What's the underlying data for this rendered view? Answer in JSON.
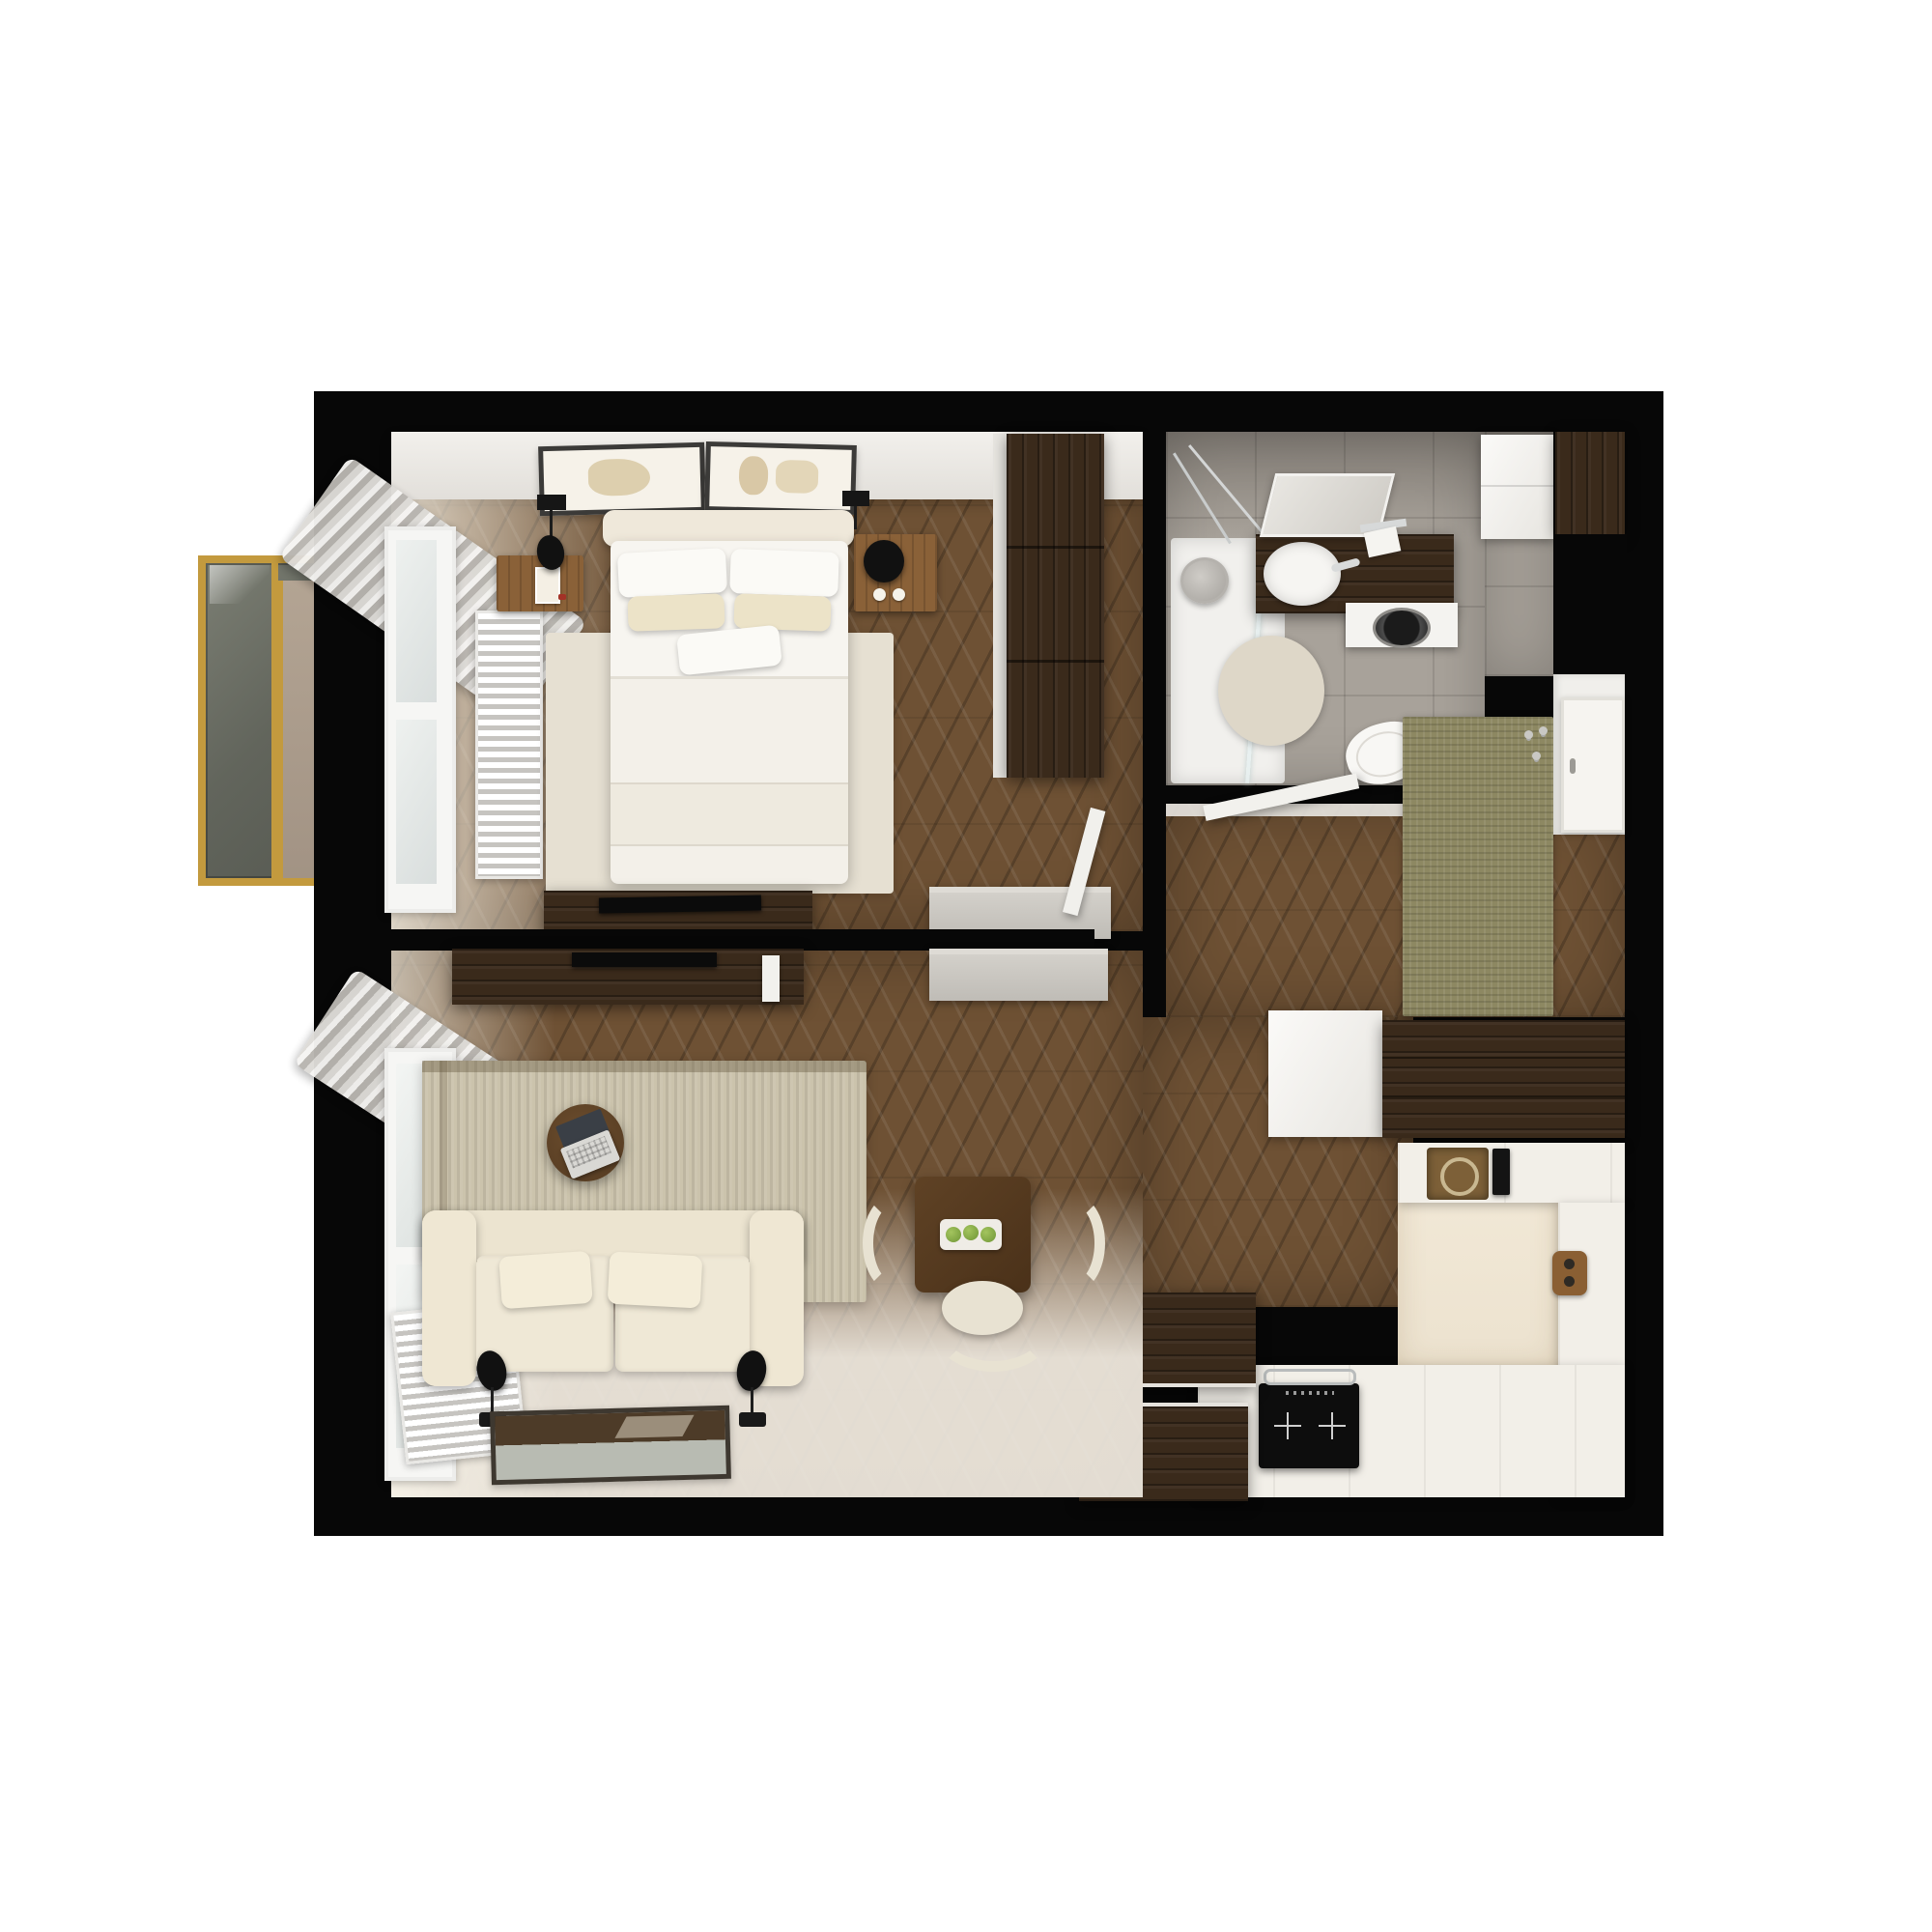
{
  "scene": {
    "type": "3d-floor-plan-top-down-render",
    "subject": "one-bedroom apartment interior visualization",
    "background": "#ffffff",
    "no_visible_text": true
  },
  "colors": {
    "paper": "#ffffff",
    "wall": "#070707",
    "wood": "#6e5134",
    "darkwood": "#3a2a1b",
    "midwood": "#8a6138",
    "tile": "#a8a29a",
    "counter": "#f2efe8",
    "cream": "#efe8d6",
    "rug-beige": "#e6e0d2",
    "rug-living": "#cbc3ac",
    "rug-green": "#8d8862",
    "gold": "#c39a3e",
    "apple-green": "#7ca23c",
    "appliance-black": "#0d0d0d"
  },
  "rooms": [
    {
      "id": "bedroom",
      "position": "top-left",
      "furniture": [
        "double-bed",
        "headboard",
        "pillows",
        "duvet",
        "nightstand-left-with-art-card",
        "nightstand-right-with-lamp",
        "wall-sconce-left",
        "wall-sconce-right",
        "two-framed-artworks",
        "radiator",
        "window",
        "curtains",
        "beige-area-rug",
        "dark-wardrobe",
        "media-bench-with-tv",
        "grey-sideboard",
        "open-door"
      ]
    },
    {
      "id": "bathroom",
      "position": "top-right",
      "furniture": [
        "walk-in-shower",
        "rain-shower-head",
        "glass-partition",
        "dark-wood-vanity",
        "white-basin",
        "tilted-mirror",
        "toilet-paper-holder",
        "washing-machine",
        "round-beige-rug",
        "wall-hung-toilet",
        "flush-plate",
        "white-storage-cabinet",
        "dark-storage-cabinet"
      ]
    },
    {
      "id": "hallway-entry",
      "position": "middle-right",
      "furniture": [
        "open-bathroom-door",
        "green-runner-rug",
        "entry-vestibule",
        "front-door",
        "coat-hooks",
        "gloss-white-cabinet",
        "dark-wardrobe-cabinet"
      ]
    },
    {
      "id": "kitchen",
      "position": "bottom-right",
      "furniture": [
        "u-shaped-white-counter",
        "bronze-square-sink",
        "black-faucet",
        "induction-hob-two-zones",
        "steel-towel-rail",
        "wood-cutting-board",
        "dark-wood-breakfast-bar",
        "white-plank-floor"
      ]
    },
    {
      "id": "living-room",
      "position": "bottom-left",
      "furniture": [
        "cream-sofa",
        "two-seat-cushions",
        "two-seat-pillows",
        "two-black-floor-lamps",
        "striped-area-rug",
        "round-coffee-table",
        "open-laptop",
        "square-dining-table",
        "three-cream-chairs",
        "tray-with-three-green-apples",
        "tv-console-with-tv",
        "white-media-device",
        "grey-sideboard",
        "framed-floor-artwork",
        "window",
        "curtains",
        "radiator"
      ]
    },
    {
      "id": "balcony-glazing",
      "position": "outside-left",
      "furniture": [
        "gold-framed-glass-panels",
        "beige-tile-strip"
      ]
    }
  ]
}
